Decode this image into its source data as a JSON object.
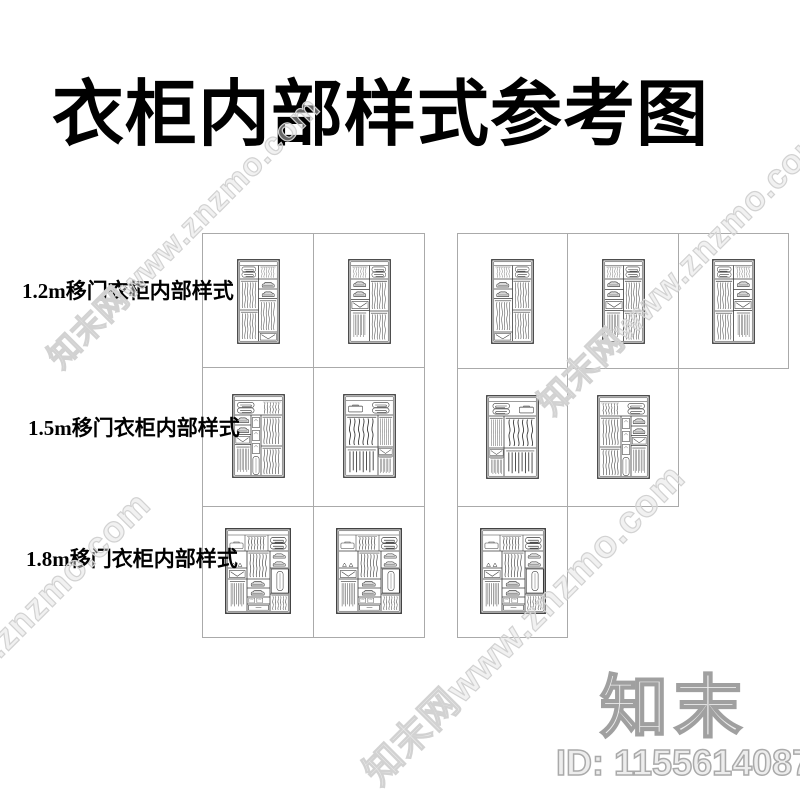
{
  "title": "衣柜内部样式参考图",
  "sections": [
    {
      "label": "1.2m移门衣柜内部样式"
    },
    {
      "label": "1.5m移门衣柜内部样式"
    },
    {
      "label": "1.8m移门衣柜内部样式"
    }
  ],
  "watermark": {
    "text": "知末网www.znzmo.com",
    "color": "#d2d2d2"
  },
  "branding": {
    "logo_text": "知末",
    "item_id": "ID: 1155614087",
    "outline_color": "#a0a0a0"
  },
  "drawing": {
    "line_color": "#3a3a3a",
    "grid_color": "#aaaaaa",
    "shade_color": "#d9d9d9"
  }
}
